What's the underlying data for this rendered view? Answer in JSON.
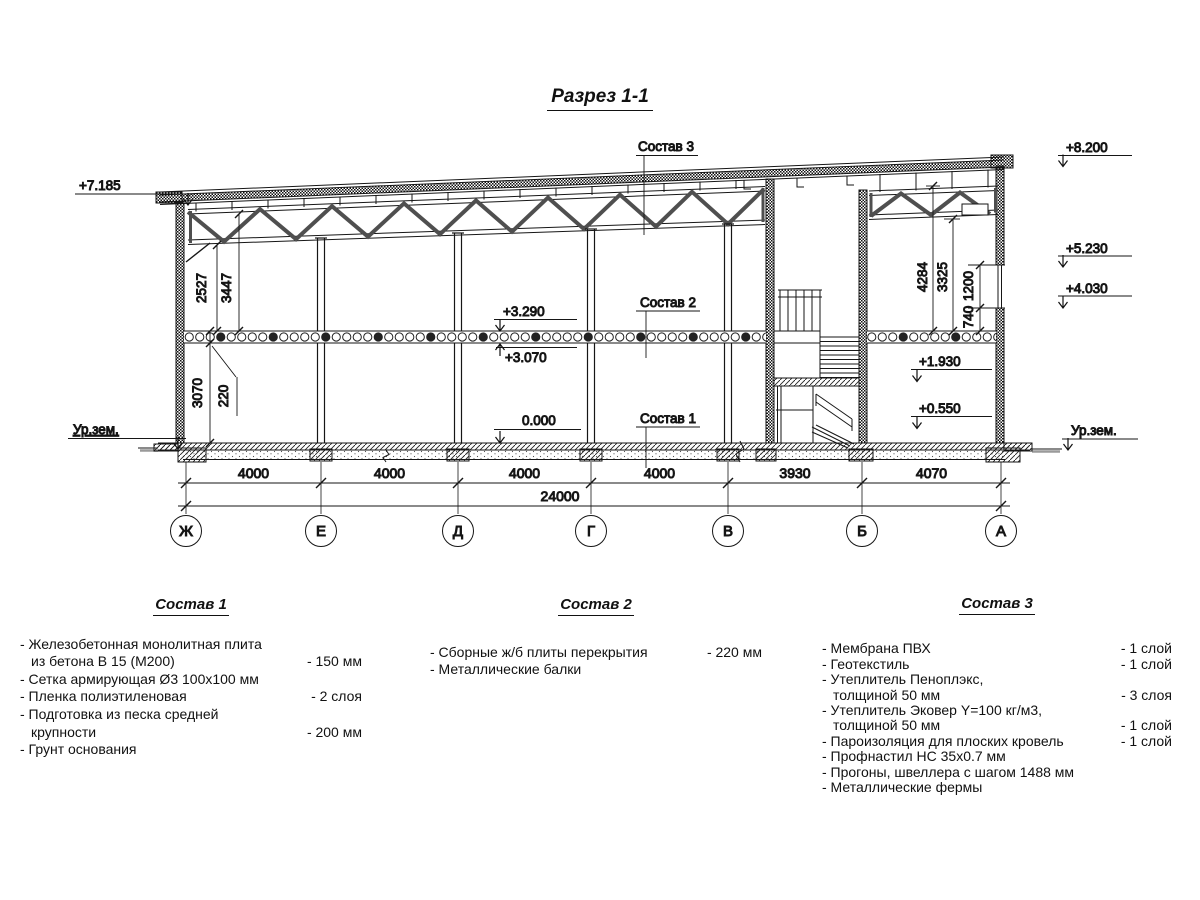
{
  "title": "Разрез 1-1",
  "marks": {
    "left_eave": "+7.185",
    "roof_top": "+8.200",
    "window_top": "+5.230",
    "window_sill": "+4.030",
    "slab_top": "+3.290",
    "slab_bottom": "+3.070",
    "floor": "0.000",
    "landing": "+1.930",
    "entry": "+0.550",
    "ground_left": "Ур.зем.",
    "ground_right": "Ур.зем."
  },
  "sostav_labels": {
    "s1": "Состав 1",
    "s2": "Состав 2",
    "s3": "Состав 3"
  },
  "dims": {
    "left": {
      "truss_bottom": "2527",
      "truss_top": "3447",
      "slab": "220",
      "floor_height": "3070"
    },
    "right": {
      "roof": "4284",
      "truss": "3325",
      "window": "1200",
      "sill": "740"
    },
    "spans": [
      "4000",
      "4000",
      "4000",
      "4000",
      "3930",
      "4070"
    ],
    "total": "24000"
  },
  "axes": [
    "Ж",
    "Е",
    "Д",
    "Г",
    "В",
    "Б",
    "А"
  ],
  "legends": [
    {
      "title": "Состав 1",
      "items": [
        {
          "line1": "- Железобетонная  монолитная плита",
          "line2": "из бетона В 15 (М200)",
          "value": "- 150 мм"
        },
        {
          "line1": "- Сетка армирующая Ø3 100x100 мм"
        },
        {
          "line1": "- Пленка полиэтиленовая",
          "value": "-  2 слоя"
        },
        {
          "line1": "- Подготовка из песка средней",
          "line2": "крупности",
          "value": "- 200 мм"
        },
        {
          "line1": "- Грунт основания"
        }
      ]
    },
    {
      "title": "Состав 2",
      "items": [
        {
          "line1": "- Сборные ж/б плиты перекрытия",
          "value": "- 220 мм"
        },
        {
          "line1": "- Металлические балки"
        }
      ]
    },
    {
      "title": "Состав 3",
      "items": [
        {
          "line1": "- Мембрана ПВХ",
          "value": "- 1 слой"
        },
        {
          "line1": "- Геотекстиль",
          "value": "- 1 слой"
        },
        {
          "line1": "- Утеплитель Пеноплэкс,",
          "line2": "толщиной 50 мм",
          "value": "- 3 слоя"
        },
        {
          "line1": "- Утеплитель Эковер Y=100 кг/м3,",
          "line2": "толщиной 50 мм",
          "value": "- 1 слой"
        },
        {
          "line1": "- Пароизоляция для плоских кровель",
          "value": "- 1 слой"
        },
        {
          "line1": "- Профнастил НС 35х0.7 мм"
        },
        {
          "line1": "- Прогоны, швеллера с шагом 1488 мм"
        },
        {
          "line1": "- Металлические фермы"
        }
      ]
    }
  ]
}
